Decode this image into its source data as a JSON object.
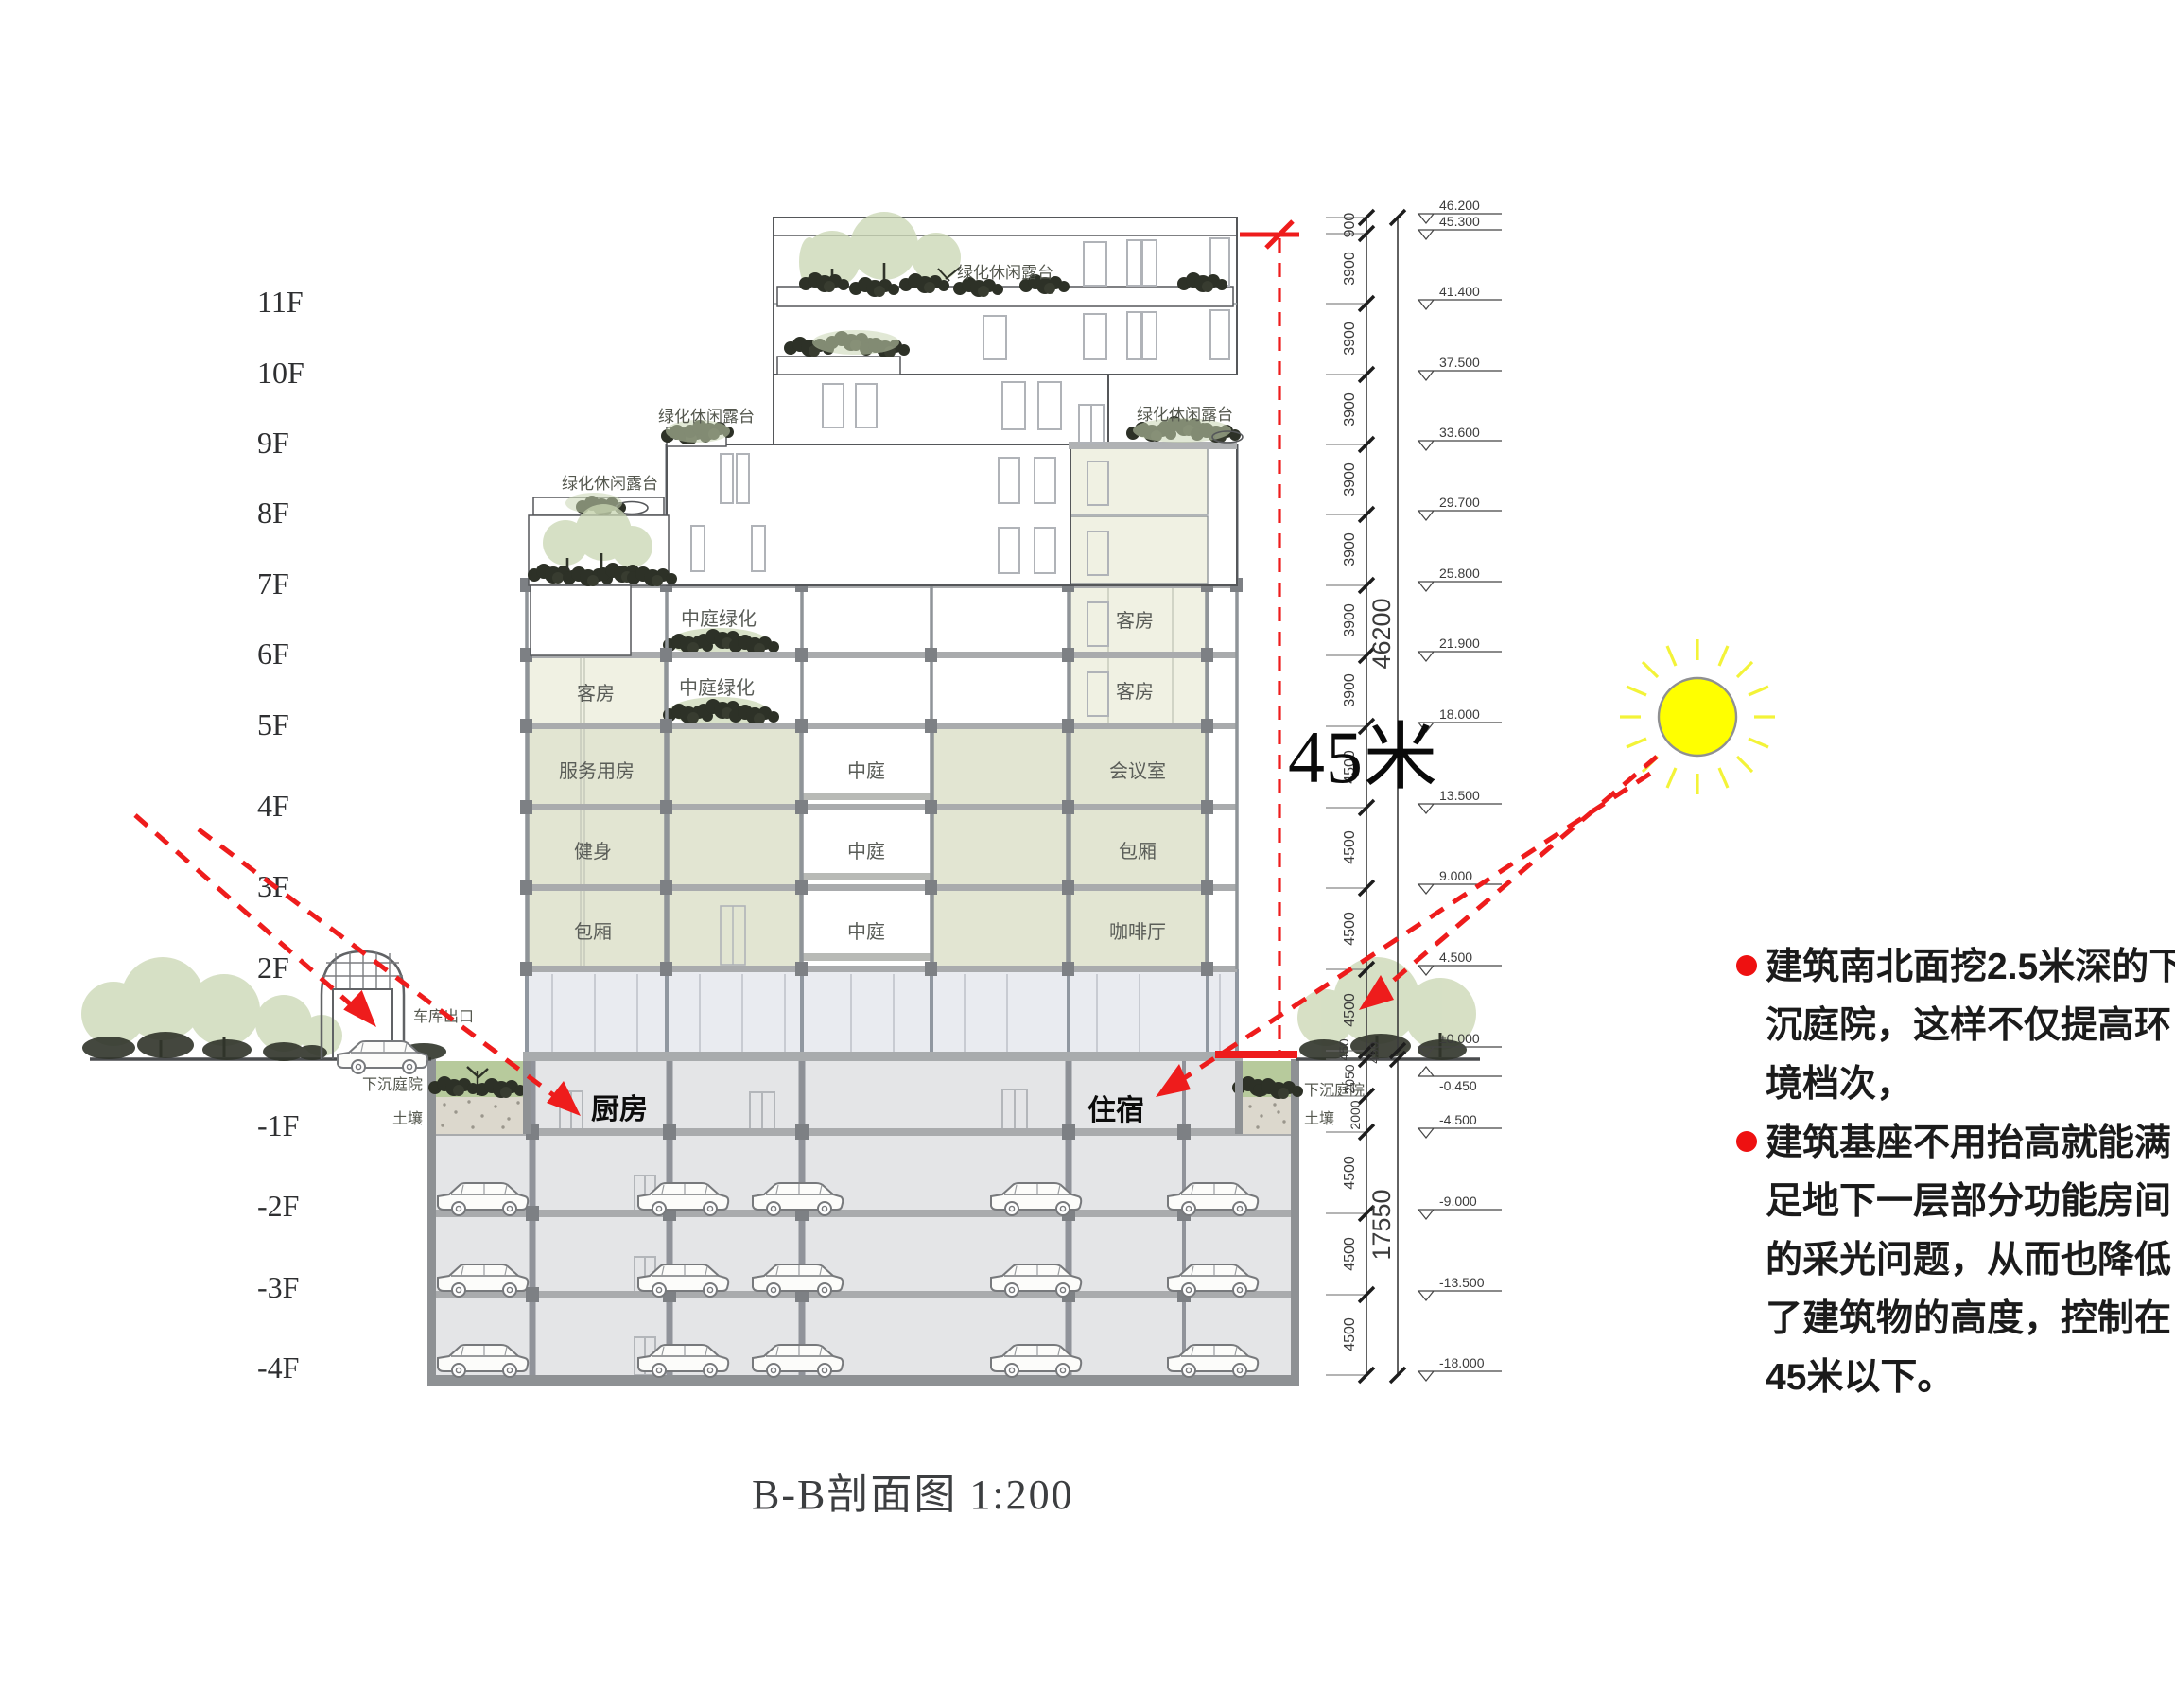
{
  "labels": {
    "floors": [
      "11F",
      "10F",
      "9F",
      "8F",
      "7F",
      "6F",
      "5F",
      "4F",
      "3F",
      "2F",
      "-1F",
      "-2F",
      "-3F",
      "-4F"
    ],
    "terrace": "绿化休闲露台",
    "atrium_green": "中庭绿化",
    "atrium": "中庭",
    "guest_room": "客房",
    "service_room": "服务用房",
    "gym": "健身",
    "private_room": "包厢",
    "meeting_room": "会议室",
    "cafe": "咖啡厅",
    "kitchen": "厨房",
    "lodging": "住宿",
    "garage_exit": "车库出口",
    "sunken_courtyard": "下沉庭院",
    "soil": "土壤",
    "height_note": "45米",
    "caption": "B-B剖面图 1:200"
  },
  "dimensions": {
    "upper_segments": [
      "900",
      "3900",
      "3900",
      "3900",
      "3900",
      "3900",
      "3900",
      "3900",
      "4500",
      "4500",
      "4500",
      "4500"
    ],
    "upper_total": "46200",
    "ground_segments": [
      "450",
      "450",
      "2050",
      "2000"
    ],
    "lower_segments": [
      "4500",
      "4500",
      "4500"
    ],
    "lower_total": "17550",
    "elevations": [
      "46.200",
      "45.300",
      "41.400",
      "37.500",
      "33.600",
      "29.700",
      "25.800",
      "21.900",
      "18.000",
      "13.500",
      "9.000",
      "4.500",
      "±0.000",
      "-0.450",
      "-4.500",
      "-9.000",
      "-13.500",
      "-18.000"
    ]
  },
  "annotations": {
    "bullet1_lines": [
      "建筑南北面挖2.5米深的下",
      "沉庭院，这样不仅提高环",
      "境档次，"
    ],
    "bullet2_lines": [
      "建筑基座不用抬高就能满",
      "足地下一层部分功能房间",
      "的采光问题，从而也降低",
      "了建筑物的高度，控制在",
      "45米以下。"
    ]
  },
  "colors": {
    "accent_red": "#ee1c1c",
    "sun_yellow": "#ffff00",
    "room_green": "#e2e5d2",
    "room_pale": "#f0f1e3",
    "canopy_green": "#c9d6b2",
    "plant_dark": "#2d3127",
    "slab_gray": "#a9abad",
    "basement_gray": "#e4e5e7"
  }
}
